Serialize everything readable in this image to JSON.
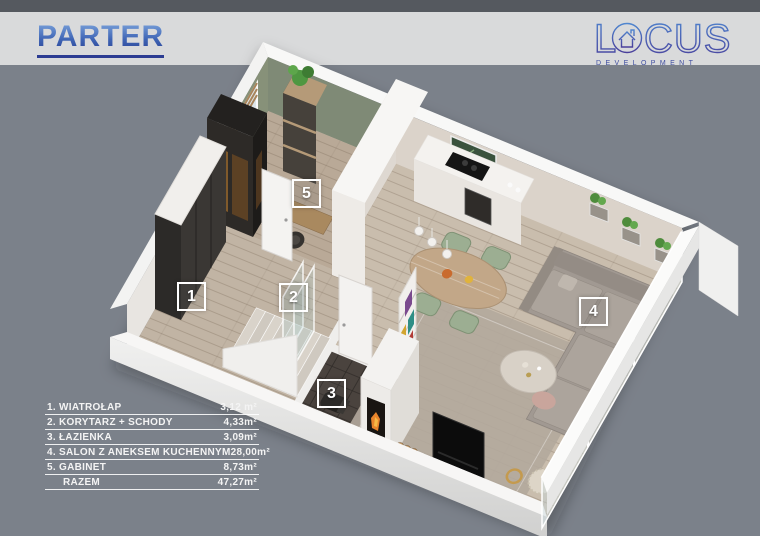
{
  "header": {
    "title": "PARTER"
  },
  "logo": {
    "letter_l": "L",
    "letters_cus": "CUS",
    "subtitle": "DEVELOPMENT"
  },
  "legend": {
    "rows": [
      {
        "label": "1. WIATROŁAP",
        "value": "3,12 m²"
      },
      {
        "label": "2. KORYTARZ + SCHODY",
        "value": "4,33m²"
      },
      {
        "label": "3. ŁAZIENKA",
        "value": "3,09m²"
      },
      {
        "label": "4. SALON Z ANEKSEM KUCHENNYM",
        "value": "28,00m²"
      },
      {
        "label": "5. GABINET",
        "value": "8,73m²"
      },
      {
        "label": "RAZEM",
        "value": "47,27m²"
      }
    ]
  },
  "plan": {
    "badges": [
      {
        "number": "1"
      },
      {
        "number": "2"
      },
      {
        "number": "3"
      },
      {
        "number": "4"
      },
      {
        "number": "5"
      }
    ]
  },
  "colors": {
    "background": "#7b818a",
    "header_band": "#d9dadb",
    "title_blue": "#2c3c92",
    "logo_blue": "#4a55a8",
    "green_wall": "#828c7a"
  }
}
